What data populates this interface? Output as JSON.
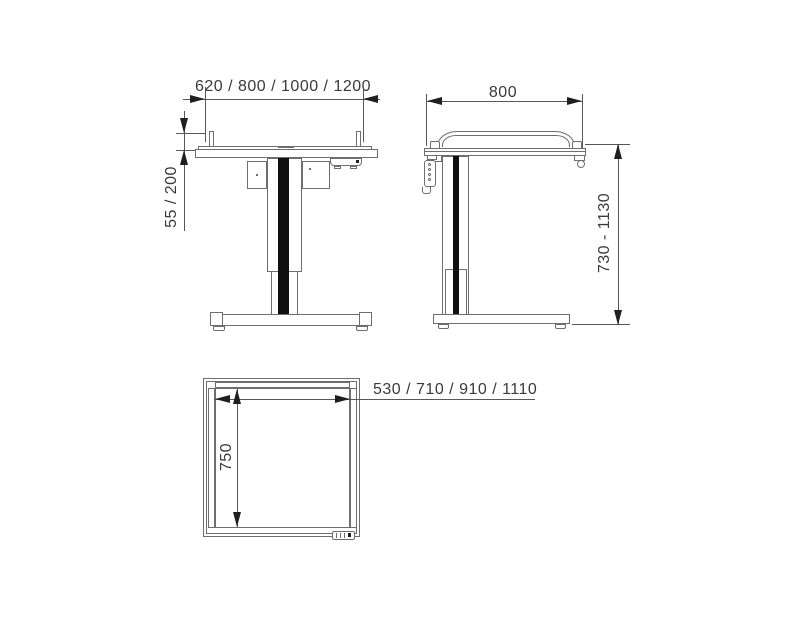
{
  "views": {
    "front": {
      "width_label": "620 / 800 / 1000 / 1200",
      "rail_height_label": "55 / 200"
    },
    "side": {
      "depth_label": "800",
      "height_range_label": "730 - 1130"
    },
    "top": {
      "clear_width_label": "530 / 710 / 910 / 1110",
      "depth_label": "750"
    }
  },
  "colors": {
    "line": "#6e6e6e",
    "dim_line": "#585858",
    "arrow": "#1f1f1f",
    "text": "#3a3a3a",
    "stripe": "#101010",
    "background": "#ffffff"
  }
}
